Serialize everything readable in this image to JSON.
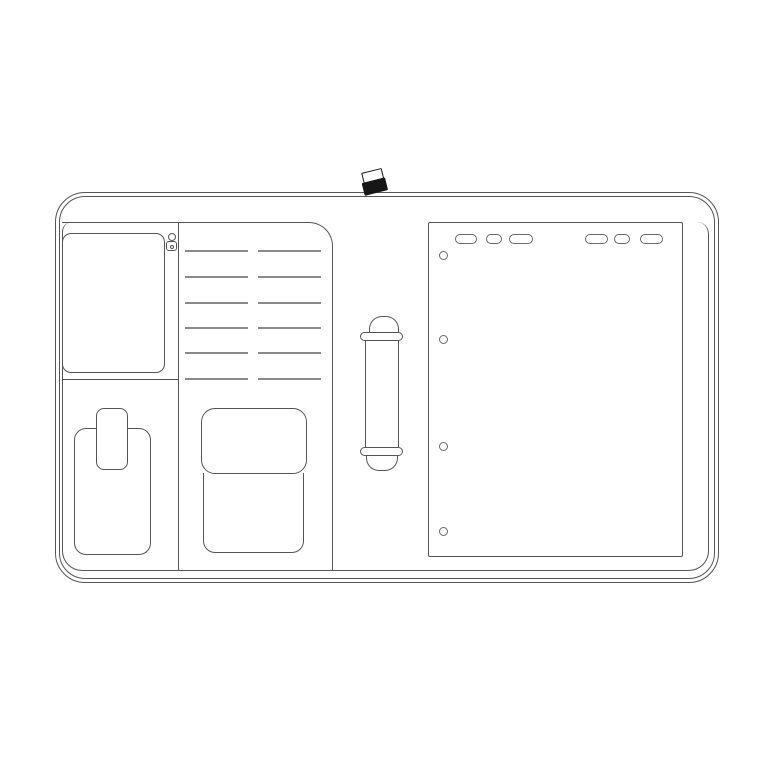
{
  "illustration": {
    "subject": "line-drawing of an open folio organizer (flat lay)",
    "canvas": {
      "width": 760,
      "height": 760,
      "background": "#ffffff"
    },
    "colors": {
      "outline": "#555555",
      "slot_line": "#8a8a8a",
      "tab_outline": "#6a6a6a",
      "clasp_fill": "#161616"
    },
    "card_slots": {
      "rows_y": [
        250,
        276,
        302,
        327,
        352,
        378
      ],
      "columns": [
        {
          "x": 185,
          "width": 63
        },
        {
          "x": 258,
          "width": 63
        }
      ]
    },
    "notepad": {
      "tabs_y": 233,
      "tab_height": 10,
      "tabs": [
        {
          "x": 454,
          "width": 22
        },
        {
          "x": 485,
          "width": 16
        },
        {
          "x": 508,
          "width": 24
        },
        {
          "x": 584,
          "width": 23
        },
        {
          "x": 613,
          "width": 16
        },
        {
          "x": 639,
          "width": 23
        }
      ],
      "holes_x_center": 442,
      "hole_diameter": 9,
      "holes_y_center": [
        254,
        338,
        445,
        530
      ]
    }
  }
}
